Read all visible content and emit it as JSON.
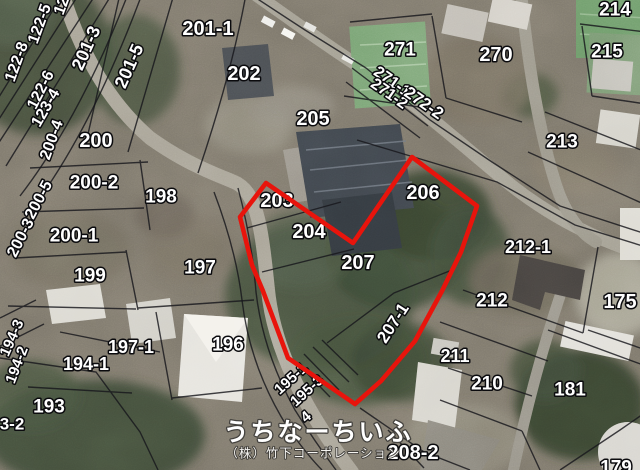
{
  "map": {
    "highlight": {
      "color": "#e8140c",
      "points": "412,157 477,206 461,252 442,291 415,341 381,381 355,404 288,358 263,291 252,265 240,217 266,183 353,243"
    },
    "watermark": {
      "line1": "うちなーちいふ",
      "line2": "（株）竹下コーポレーション"
    },
    "labels": [
      {
        "text": "201-1",
        "x": 208,
        "y": 29,
        "size": 20
      },
      {
        "text": "202",
        "x": 244,
        "y": 74,
        "size": 20
      },
      {
        "text": "205",
        "x": 313,
        "y": 119,
        "size": 20
      },
      {
        "text": "271",
        "x": 400,
        "y": 50,
        "size": 19
      },
      {
        "text": "271-1",
        "x": 392,
        "y": 82,
        "rot": 35,
        "size": 16
      },
      {
        "text": "271-2",
        "x": 389,
        "y": 94,
        "rot": 35,
        "size": 16
      },
      {
        "text": "272-2",
        "x": 424,
        "y": 103,
        "rot": 35,
        "size": 17
      },
      {
        "text": "270",
        "x": 496,
        "y": 55,
        "size": 20
      },
      {
        "text": "214",
        "x": 615,
        "y": 10,
        "size": 19
      },
      {
        "text": "215",
        "x": 607,
        "y": 52,
        "size": 19
      },
      {
        "text": "213",
        "x": 562,
        "y": 142,
        "size": 19
      },
      {
        "text": "206",
        "x": 423,
        "y": 193,
        "size": 20
      },
      {
        "text": "203",
        "x": 277,
        "y": 201,
        "size": 20
      },
      {
        "text": "204",
        "x": 309,
        "y": 232,
        "size": 20
      },
      {
        "text": "207",
        "x": 358,
        "y": 263,
        "size": 20
      },
      {
        "text": "207-1",
        "x": 393,
        "y": 323,
        "rot": -57,
        "size": 17
      },
      {
        "text": "200",
        "x": 96,
        "y": 141,
        "size": 20
      },
      {
        "text": "200-2",
        "x": 94,
        "y": 183,
        "size": 19
      },
      {
        "text": "198",
        "x": 161,
        "y": 197,
        "size": 19
      },
      {
        "text": "200-1",
        "x": 74,
        "y": 236,
        "size": 19
      },
      {
        "text": "199",
        "x": 90,
        "y": 276,
        "size": 19
      },
      {
        "text": "197",
        "x": 200,
        "y": 268,
        "size": 19
      },
      {
        "text": "196",
        "x": 228,
        "y": 345,
        "size": 19
      },
      {
        "text": "197-1",
        "x": 131,
        "y": 347,
        "size": 18
      },
      {
        "text": "194-1",
        "x": 86,
        "y": 364,
        "size": 18
      },
      {
        "text": "193",
        "x": 49,
        "y": 407,
        "size": 19
      },
      {
        "text": "3-2",
        "x": 12,
        "y": 424,
        "size": 17
      },
      {
        "text": "212-1",
        "x": 528,
        "y": 247,
        "size": 18
      },
      {
        "text": "212",
        "x": 492,
        "y": 301,
        "size": 19
      },
      {
        "text": "175",
        "x": 620,
        "y": 302,
        "size": 20
      },
      {
        "text": "211",
        "x": 455,
        "y": 356,
        "size": 18
      },
      {
        "text": "210",
        "x": 487,
        "y": 384,
        "size": 19
      },
      {
        "text": "181",
        "x": 570,
        "y": 390,
        "size": 19
      },
      {
        "text": "208-2",
        "x": 413,
        "y": 453,
        "size": 20
      },
      {
        "text": "179",
        "x": 616,
        "y": 468,
        "size": 19
      },
      {
        "text": "122-8",
        "x": 17,
        "y": 62,
        "rot": -70,
        "size": 16
      },
      {
        "text": "122-5",
        "x": 40,
        "y": 24,
        "rot": -70,
        "size": 16
      },
      {
        "text": "12",
        "x": 62,
        "y": 6,
        "rot": -70,
        "size": 16
      },
      {
        "text": "122-6",
        "x": 41,
        "y": 90,
        "rot": -63,
        "size": 16
      },
      {
        "text": "123-4",
        "x": 46,
        "y": 108,
        "rot": -60,
        "size": 16
      },
      {
        "text": "201-3",
        "x": 86,
        "y": 48,
        "rot": -66,
        "size": 18
      },
      {
        "text": "201-5",
        "x": 129,
        "y": 66,
        "rot": -66,
        "size": 18
      },
      {
        "text": "200-4",
        "x": 52,
        "y": 140,
        "rot": -70,
        "size": 16
      },
      {
        "text": "200-5",
        "x": 39,
        "y": 200,
        "rot": -62,
        "size": 16
      },
      {
        "text": "200-3",
        "x": 21,
        "y": 238,
        "rot": -63,
        "size": 16
      },
      {
        "text": "194-3",
        "x": 12,
        "y": 338,
        "rot": -66,
        "size": 15
      },
      {
        "text": "194-2",
        "x": 17,
        "y": 365,
        "rot": -69,
        "size": 15
      },
      {
        "text": "195-1",
        "x": 291,
        "y": 379,
        "rot": -42,
        "size": 15
      },
      {
        "text": "195-3",
        "x": 307,
        "y": 391,
        "rot": -42,
        "size": 15
      },
      {
        "text": "4",
        "x": 306,
        "y": 417,
        "rot": -40,
        "size": 15
      }
    ]
  }
}
